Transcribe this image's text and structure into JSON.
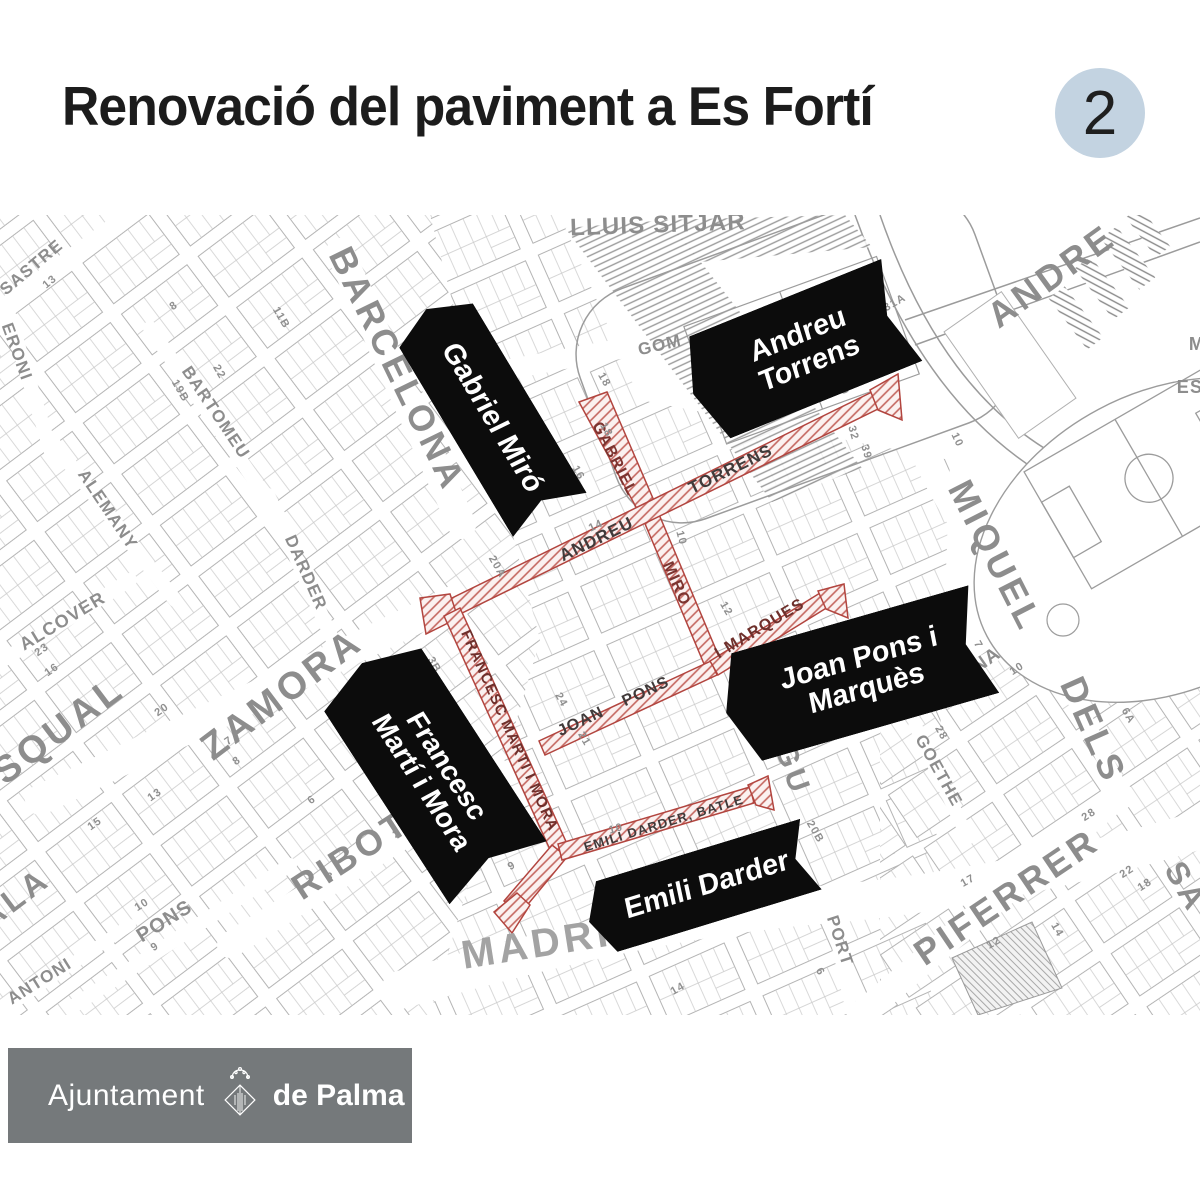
{
  "title": "Renovació del paviment a Es Fortí",
  "badge": "2",
  "footer": {
    "org_regular": "Ajuntament",
    "org_bold": "de Palma"
  },
  "colors": {
    "title_text": "#1c1c1c",
    "badge_bg": "#c3d3e1",
    "banner_bg": "#0c0c0c",
    "banner_text": "#ffffff",
    "footer_bg": "#75797b",
    "red_outline": "#b2453f",
    "red_hatch": "#c4665f",
    "map_gray": "#8d8d8d"
  },
  "map": {
    "banners": [
      {
        "id": "gabriel-miro",
        "lines": [
          "Gabriel Miró"
        ],
        "x": 488,
        "y": 412,
        "w": 240,
        "h": 86,
        "rot": 59,
        "fs": 29
      },
      {
        "id": "andreu-torrens",
        "lines": [
          "Andreu",
          "Torrens"
        ],
        "x": 797,
        "y": 352,
        "w": 225,
        "h": 110,
        "rot": -22,
        "fs": 29
      },
      {
        "id": "francesc-marti-i-mora",
        "lines": [
          "Francesc",
          "Martí i Mora"
        ],
        "x": 430,
        "y": 768,
        "w": 250,
        "h": 116,
        "rot": 57,
        "fs": 28
      },
      {
        "id": "joan-pons-i-marques",
        "lines": [
          "Joan Pons i",
          "Marquès"
        ],
        "x": 855,
        "y": 676,
        "w": 268,
        "h": 112,
        "rot": -16,
        "fs": 29
      },
      {
        "id": "emili-darder",
        "lines": [
          "Emili Darder"
        ],
        "x": 700,
        "y": 888,
        "w": 232,
        "h": 74,
        "rot": -17,
        "fs": 29
      }
    ],
    "highlight_streets": [
      {
        "id": "gabriel-miro",
        "polys": [
          "579,402 607,392 658,510 643,520",
          "643,519 658,512 722,664 707,671"
        ]
      },
      {
        "id": "andreu-torrens",
        "polys": [
          "448,600 456,616 880,408 872,392",
          "450,594 458,618 426,634 420,598",
          "870,390 878,410 902,420 898,374"
        ]
      },
      {
        "id": "joan-pons-i-marques",
        "polys": [
          "539,741 545,755 717,675 711,661",
          "710,661 718,675 828,607 820,593",
          "818,591 826,609 848,618 844,584"
        ]
      },
      {
        "id": "francesc-marti-i-mora",
        "polys": [
          "444,616 460,608 568,846 552,854",
          "552,845 567,857 519,915 504,901",
          "517,893 530,905 512,933 494,912"
        ]
      },
      {
        "id": "emili-darder",
        "polys": [
          "558,844 562,860 754,803 750,787",
          "748,785 756,805 774,810 768,776"
        ]
      }
    ],
    "red_labels": [
      {
        "t": "GABRIEL",
        "x": 614,
        "y": 459,
        "r": 63,
        "s": 16,
        "c": "#7c3430"
      },
      {
        "t": "MIRO",
        "x": 676,
        "y": 584,
        "r": 66,
        "s": 16,
        "c": "#7c3430"
      },
      {
        "t": "ANDREU",
        "x": 597,
        "y": 540,
        "r": -26,
        "s": 17,
        "c": "#403a3a"
      },
      {
        "t": "TORRENS",
        "x": 731,
        "y": 470,
        "r": -26,
        "s": 17,
        "c": "#403a3a"
      },
      {
        "t": "JOAN",
        "x": 581,
        "y": 722,
        "r": -25,
        "s": 16,
        "c": "#403a3a"
      },
      {
        "t": "PONS",
        "x": 646,
        "y": 692,
        "r": -25,
        "s": 16,
        "c": "#403a3a"
      },
      {
        "t": "I  MARQUES",
        "x": 760,
        "y": 629,
        "r": -31,
        "s": 16,
        "c": "#6e2f2b"
      },
      {
        "t": "FRANCESC MARTI I MORA",
        "x": 509,
        "y": 731,
        "r": 66,
        "s": 15,
        "c": "#6e2f2b"
      },
      {
        "t": "EMILI DARDER, BATLE",
        "x": 664,
        "y": 824,
        "r": -17,
        "s": 13,
        "c": "#403a3a"
      }
    ],
    "street_labels": [
      {
        "t": "SASTRE",
        "x": 32,
        "y": 268,
        "r": -40,
        "s": 17
      },
      {
        "t": "ERONI",
        "x": 16,
        "y": 352,
        "r": 70,
        "s": 17
      },
      {
        "t": "BARTOMEU",
        "x": 215,
        "y": 413,
        "r": 56,
        "s": 17
      },
      {
        "t": "ALEMANY",
        "x": 107,
        "y": 510,
        "r": 56,
        "s": 17
      },
      {
        "t": "BARCELONA",
        "x": 395,
        "y": 370,
        "r": 64,
        "s": 36
      },
      {
        "t": "ALCOVER",
        "x": 63,
        "y": 622,
        "r": -31,
        "s": 18
      },
      {
        "t": "ZAMORA",
        "x": 283,
        "y": 696,
        "r": -37,
        "s": 38
      },
      {
        "t": "SQUAL",
        "x": 60,
        "y": 732,
        "r": -37,
        "s": 38
      },
      {
        "t": "DARDER",
        "x": 305,
        "y": 573,
        "r": 66,
        "s": 17
      },
      {
        "t": "RIBOT",
        "x": 352,
        "y": 857,
        "r": -33,
        "s": 36
      },
      {
        "t": "PONS",
        "x": 165,
        "y": 922,
        "r": -32,
        "s": 20
      },
      {
        "t": "ANTONI",
        "x": 40,
        "y": 982,
        "r": -32,
        "s": 17
      },
      {
        "t": "ALA",
        "x": 16,
        "y": 900,
        "r": -37,
        "s": 32
      },
      {
        "t": "MADRID",
        "x": 553,
        "y": 944,
        "r": -9,
        "s": 40,
        "c": "#a3a3a3"
      },
      {
        "t": "LLUIS SITJAR",
        "x": 658,
        "y": 226,
        "r": -2,
        "s": 24
      },
      {
        "t": "TOR",
        "x": 487,
        "y": 362,
        "r": -11,
        "s": 17
      },
      {
        "t": "GOM",
        "x": 660,
        "y": 346,
        "r": -13,
        "s": 17
      },
      {
        "t": "ANDRE",
        "x": 1053,
        "y": 278,
        "r": -36,
        "s": 36
      },
      {
        "t": "MIQUEL",
        "x": 993,
        "y": 557,
        "r": 63,
        "s": 36
      },
      {
        "t": "DELS",
        "x": 1091,
        "y": 731,
        "r": 66,
        "s": 36
      },
      {
        "t": "DIANA",
        "x": 972,
        "y": 671,
        "r": -35,
        "s": 19
      },
      {
        "t": "GOETHE",
        "x": 938,
        "y": 771,
        "r": 61,
        "s": 17
      },
      {
        "t": "PIFERRER",
        "x": 1008,
        "y": 899,
        "r": -34,
        "s": 36
      },
      {
        "t": "SA",
        "x": 1184,
        "y": 888,
        "r": 60,
        "s": 32
      },
      {
        "t": "PORT",
        "x": 839,
        "y": 941,
        "r": 72,
        "s": 17
      },
      {
        "t": "GU",
        "x": 791,
        "y": 770,
        "r": 70,
        "s": 30
      },
      {
        "t": "ES",
        "x": 1190,
        "y": 388,
        "r": 0,
        "s": 18
      },
      {
        "t": "M",
        "x": 1197,
        "y": 345,
        "r": 0,
        "s": 18
      }
    ],
    "lot_numbers": [
      {
        "t": "18",
        "x": 606,
        "y": 430,
        "r": 60
      },
      {
        "t": "16",
        "x": 578,
        "y": 473,
        "r": 60
      },
      {
        "t": "14",
        "x": 596,
        "y": 526,
        "r": -25
      },
      {
        "t": "20A",
        "x": 497,
        "y": 567,
        "r": 60
      },
      {
        "t": "32",
        "x": 853,
        "y": 433,
        "r": 75
      },
      {
        "t": "39",
        "x": 866,
        "y": 452,
        "r": 75
      },
      {
        "t": "12",
        "x": 726,
        "y": 609,
        "r": 60
      },
      {
        "t": "10",
        "x": 681,
        "y": 538,
        "r": 75
      },
      {
        "t": "24",
        "x": 561,
        "y": 700,
        "r": 60
      },
      {
        "t": "21",
        "x": 584,
        "y": 739,
        "r": 60
      },
      {
        "t": "3B",
        "x": 434,
        "y": 665,
        "r": 60
      },
      {
        "t": "9",
        "x": 512,
        "y": 866,
        "r": -30
      },
      {
        "t": "10",
        "x": 616,
        "y": 829,
        "r": -15
      },
      {
        "t": "14",
        "x": 678,
        "y": 989,
        "r": -30
      },
      {
        "t": "13",
        "x": 155,
        "y": 795,
        "r": -35
      },
      {
        "t": "15",
        "x": 95,
        "y": 824,
        "r": -35
      },
      {
        "t": "20",
        "x": 162,
        "y": 710,
        "r": -35
      },
      {
        "t": "23",
        "x": 42,
        "y": 650,
        "r": -35
      },
      {
        "t": "16",
        "x": 52,
        "y": 670,
        "r": -35
      },
      {
        "t": "7",
        "x": 229,
        "y": 741,
        "r": -35
      },
      {
        "t": "8",
        "x": 237,
        "y": 761,
        "r": -35
      },
      {
        "t": "6",
        "x": 312,
        "y": 800,
        "r": -35
      },
      {
        "t": "31A",
        "x": 895,
        "y": 303,
        "r": -30
      },
      {
        "t": "10",
        "x": 957,
        "y": 440,
        "r": 65
      },
      {
        "t": "29",
        "x": 843,
        "y": 388,
        "r": 70
      },
      {
        "t": "11B",
        "x": 281,
        "y": 318,
        "r": 60
      },
      {
        "t": "19B",
        "x": 180,
        "y": 391,
        "r": 60
      },
      {
        "t": "22",
        "x": 219,
        "y": 372,
        "r": 60
      },
      {
        "t": "8",
        "x": 174,
        "y": 306,
        "r": -35
      },
      {
        "t": "13",
        "x": 50,
        "y": 282,
        "r": -40
      },
      {
        "t": "17",
        "x": 968,
        "y": 881,
        "r": -30
      },
      {
        "t": "12",
        "x": 994,
        "y": 943,
        "r": -30
      },
      {
        "t": "14",
        "x": 1057,
        "y": 930,
        "r": 60
      },
      {
        "t": "6",
        "x": 820,
        "y": 972,
        "r": 60
      },
      {
        "t": "20B",
        "x": 815,
        "y": 832,
        "r": 60
      },
      {
        "t": "28",
        "x": 941,
        "y": 733,
        "r": 60
      },
      {
        "t": "28",
        "x": 1089,
        "y": 815,
        "r": -33
      },
      {
        "t": "7",
        "x": 978,
        "y": 645,
        "r": 60
      },
      {
        "t": "10",
        "x": 1017,
        "y": 669,
        "r": -33
      },
      {
        "t": "6A",
        "x": 1128,
        "y": 716,
        "r": 60
      },
      {
        "t": "22",
        "x": 1127,
        "y": 872,
        "r": -33
      },
      {
        "t": "18",
        "x": 1145,
        "y": 885,
        "r": -33
      },
      {
        "t": "2",
        "x": 397,
        "y": 834,
        "r": -33
      },
      {
        "t": "3",
        "x": 330,
        "y": 877,
        "r": 0
      },
      {
        "t": "9",
        "x": 155,
        "y": 947,
        "r": -32
      },
      {
        "t": "10",
        "x": 142,
        "y": 905,
        "r": -32
      },
      {
        "t": "8",
        "x": 520,
        "y": 495,
        "r": 60
      },
      {
        "t": "18",
        "x": 604,
        "y": 380,
        "r": 60
      }
    ]
  }
}
